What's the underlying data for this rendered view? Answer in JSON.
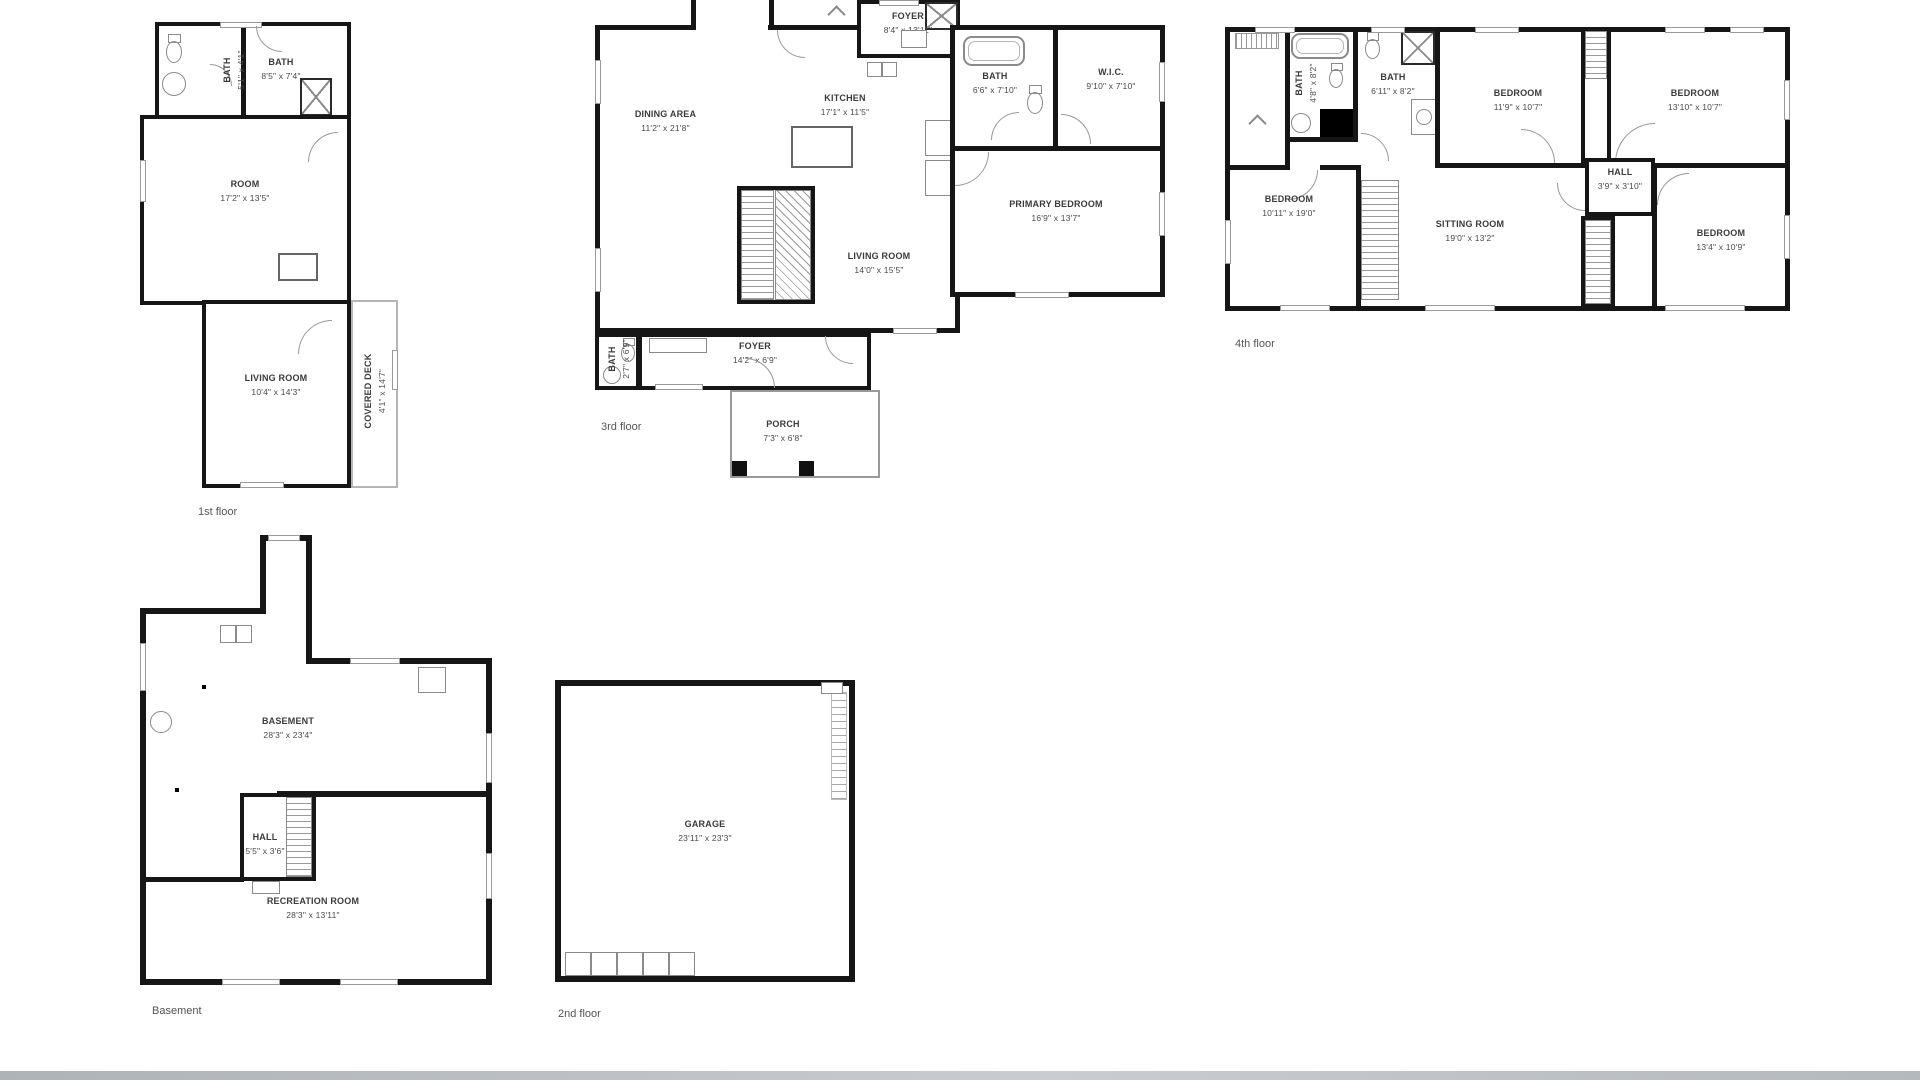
{
  "floors": {
    "first": {
      "label": "1st floor",
      "rooms": {
        "bath_small": {
          "name": "BATH",
          "dims": "5'1\" x 4'1\""
        },
        "bath": {
          "name": "BATH",
          "dims": "8'5\" x 7'4\""
        },
        "room": {
          "name": "ROOM",
          "dims": "17'2\" x 13'5\""
        },
        "living_room": {
          "name": "LIVING ROOM",
          "dims": "10'4\" x 14'3\""
        },
        "covered_deck": {
          "name": "COVERED DECK",
          "dims": "4'1\" x 14'7\""
        }
      }
    },
    "second": {
      "label": "2nd floor",
      "rooms": {
        "garage": {
          "name": "GARAGE",
          "dims": "23'11\" x 23'3\""
        }
      }
    },
    "third": {
      "label": "3rd floor",
      "rooms": {
        "foyer_upper": {
          "name": "FOYER",
          "dims": "8'4\" x 13'11\""
        },
        "kitchen": {
          "name": "KITCHEN",
          "dims": "17'1\" x 11'5\""
        },
        "dining": {
          "name": "DINING AREA",
          "dims": "11'2\" x 21'8\""
        },
        "bath": {
          "name": "BATH",
          "dims": "6'6\" x 7'10\""
        },
        "wic": {
          "name": "W.I.C.",
          "dims": "9'10\" x 7'10\""
        },
        "primary": {
          "name": "PRIMARY BEDROOM",
          "dims": "16'9\" x 13'7\""
        },
        "living_room": {
          "name": "LIVING ROOM",
          "dims": "14'0\" x 15'5\""
        },
        "foyer_lower": {
          "name": "FOYER",
          "dims": "14'2\" x 6'9\""
        },
        "bath_small": {
          "name": "BATH",
          "dims": "2'7\" x 6'9\""
        },
        "porch": {
          "name": "PORCH",
          "dims": "7'3\" x 6'8\""
        }
      }
    },
    "fourth": {
      "label": "4th floor",
      "rooms": {
        "bath_small": {
          "name": "BATH",
          "dims": "4'8\" x 8'2\""
        },
        "bath": {
          "name": "BATH",
          "dims": "6'11\" x 8'2\""
        },
        "bedroom_1": {
          "name": "BEDROOM",
          "dims": "11'9\" x 10'7\""
        },
        "bedroom_2": {
          "name": "BEDROOM",
          "dims": "13'10\" x 10'7\""
        },
        "bedroom_3": {
          "name": "BEDROOM",
          "dims": "10'11\" x 19'0\""
        },
        "sitting": {
          "name": "SITTING ROOM",
          "dims": "19'0\" x 13'2\""
        },
        "hall": {
          "name": "HALL",
          "dims": "3'9\" x 3'10\""
        },
        "bedroom_4": {
          "name": "BEDROOM",
          "dims": "13'4\" x 10'9\""
        }
      }
    },
    "basement": {
      "label": "Basement",
      "rooms": {
        "basement": {
          "name": "BASEMENT",
          "dims": "28'3\" x 23'4\""
        },
        "hall": {
          "name": "HALL",
          "dims": "5'5\" x 3'6\""
        },
        "recreation": {
          "name": "RECREATION ROOM",
          "dims": "28'3\" x 13'11\""
        }
      }
    }
  },
  "colors": {
    "wall": "#161616",
    "fixture": "#8a8a8a",
    "window_border": "#9a9a9a",
    "label_text": "#3b3b3b",
    "floor_label_text": "#555555",
    "background": "#ffffff"
  }
}
